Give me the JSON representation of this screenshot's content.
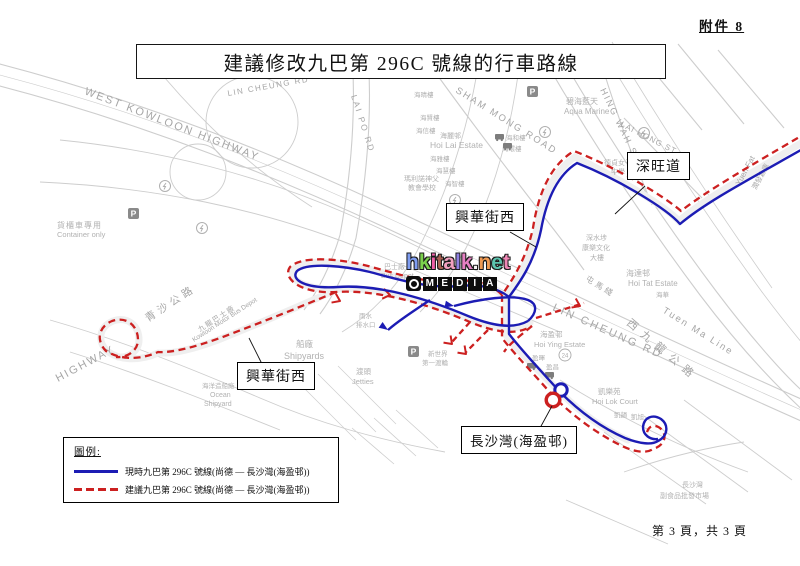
{
  "page": {
    "attachment": "附件 8",
    "title": "建議修改九巴第 296C 號線的行車路線",
    "footer": "第 3 頁，共 3 頁"
  },
  "watermark": {
    "site": "hkitalk.net",
    "badge": "MEDIA",
    "site_letters": [
      {
        "ch": "h",
        "color": "#7f9df1"
      },
      {
        "ch": "k",
        "color": "#7bd14d"
      },
      {
        "ch": "i",
        "color": "#ef5fa7"
      },
      {
        "ch": "t",
        "color": "#a85f52"
      },
      {
        "ch": "a",
        "color": "#f2a0c0"
      },
      {
        "ch": "l",
        "color": "#8f7fe0"
      },
      {
        "ch": "k",
        "color": "#e57fc2"
      },
      {
        "ch": ".",
        "color": "#f5f5f5"
      },
      {
        "ch": "n",
        "color": "#f09a52"
      },
      {
        "ch": "e",
        "color": "#5cc3ae"
      },
      {
        "ch": "t",
        "color": "#ef87b5"
      }
    ]
  },
  "legend": {
    "heading": "圖例:",
    "items": [
      {
        "style": "solid",
        "color": "#1c1cb4",
        "label": "現時九巴第 296C 號線(尚德 — 長沙灣(海盈邨))"
      },
      {
        "style": "dashed",
        "color": "#cc2020",
        "label": "建議九巴第 296C 號線(尚德 — 長沙灣(海盈邨))"
      }
    ]
  },
  "callouts": {
    "sham_mong_road": "深旺道",
    "hing_wah_st_west_upper": "興華街西",
    "hing_wah_st_west_lower": "興華街西",
    "terminus": "長沙灣(海盈邨)"
  },
  "map": {
    "labels": {
      "wkh": "WEST KOWLOON HIGHWAY",
      "highway": "HIGHWAY",
      "tsing_sha": "青沙公路",
      "wk_corridor_zh": "西九龍公路",
      "lin_cheung_rd": "LIN CHEUNG RD",
      "lin_cheung_rd_upper": "LIN CHEUNG RD",
      "sham_mong_road": "SHAM MONG ROAD",
      "hing_wah_st": "HING WAH ST",
      "lai_po_rd": "LAI PO RD",
      "lai_hong_st": "LAI HONG ST",
      "tuen_ma_line_en": "Tuen Ma Line",
      "tuen_ma_line_zh": "屯馬綫",
      "yuen_fat_en": "Yuen Fat",
      "yuen_fat_zh": "潤發倉庫",
      "container_zh": "貨櫃車專用",
      "container_en": "Container only",
      "aqua_zh": "碧海藍天",
      "aqua_en": "Aqua Marine",
      "hoi_lai_zh": "海麗邨",
      "hoi_lai_en": "Hoi Lai Estate",
      "hoi_ching": "海晴樓",
      "hoi_yin": "海賢樓",
      "hoi_shun": "海信樓",
      "hoi_nga": "海雅樓",
      "hoi_wai": "海慧樓",
      "hoi_chi": "海智樓",
      "hoi_wo": "海和樓",
      "hoi_wan": "海環樓",
      "hoi_tat_zh": "海達邨",
      "hoi_tat_en": "Hoi Tat Estate",
      "hoi_wah": "海華",
      "hoi_ying_zh": "海盈邨",
      "hoi_ying_en": "Hoi Ying Estate",
      "ying_fai": "盈暉",
      "ying_cheong": "盈昌",
      "hoi_lok_zh": "凱樂苑",
      "hoi_lok_en": "Hoi Lok Court",
      "hoi_block1": "凱韻",
      "hoi_block2": "凱旭",
      "tack_ching1": "德貞女子",
      "tack_ching2": "中學",
      "ssp1": "深水埗",
      "ssp2": "康樂文化",
      "ssp3": "大樓",
      "maryknoll1": "瑪利諾神父",
      "maryknoll2": "教會學校",
      "kmb_zh": "九龍巴士廠",
      "kmb_en": "Kowloon Motor Bus Depot",
      "bus_depot_zh": "巴士廠",
      "bus_depot_en": "Bus Depot",
      "storm1": "雨水",
      "storm2": "排水口",
      "shipyards_zh": "船廠",
      "shipyards_en": "Shipyards",
      "jetties_zh": "渡頭",
      "jetties_en": "Jetties",
      "ocean_zh": "海洋造船廠",
      "ocean_en1": "Ocean",
      "ocean_en2": "Shipyard",
      "nwff1": "新世界",
      "nwff2": "第一渡輪",
      "csw_market1": "長沙灣",
      "csw_market2": "副食品批發市場"
    },
    "icons": {
      "parking": "P",
      "exit_badge": "24"
    }
  }
}
